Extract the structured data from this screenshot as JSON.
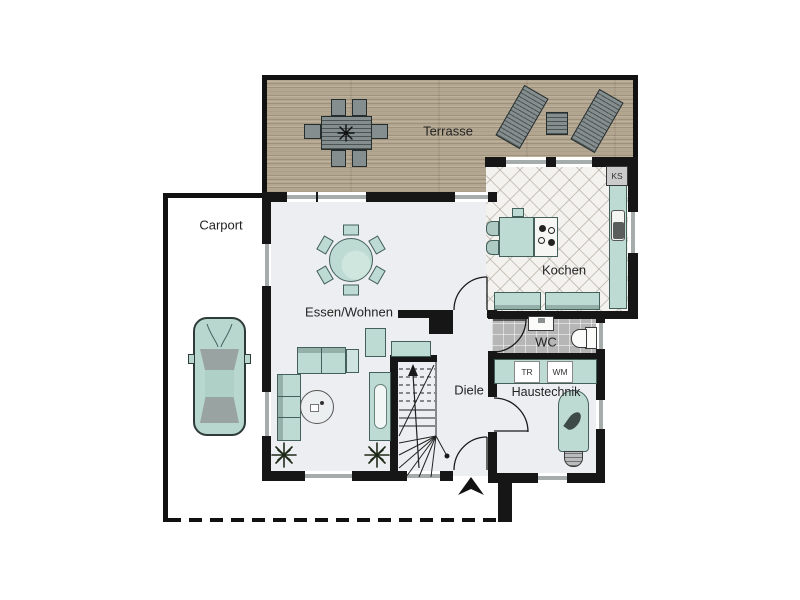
{
  "plan": {
    "rooms": {
      "carport": {
        "label": "Carport"
      },
      "terrace": {
        "label": "Terrasse"
      },
      "living": {
        "label": "Essen/Wohnen"
      },
      "kitchen": {
        "label": "Kochen"
      },
      "wc": {
        "label": "WC"
      },
      "hallway": {
        "label": "Diele"
      },
      "utility": {
        "label": "Haustechnik"
      }
    },
    "appliances": {
      "fridge": {
        "label": "KS"
      },
      "dryer": {
        "label": "TR"
      },
      "washer": {
        "label": "WM"
      }
    },
    "colors": {
      "wall": "#161616",
      "furniture_teal": "#bedbd3",
      "terrace_wood": "#b3a690",
      "floor_light": "#edeef1",
      "floor_wc": "#b6b6b6",
      "floor_kitchen": "#f3f2ee"
    },
    "icons": {
      "entrance_arrow": "up",
      "stair_direction": "up"
    }
  }
}
